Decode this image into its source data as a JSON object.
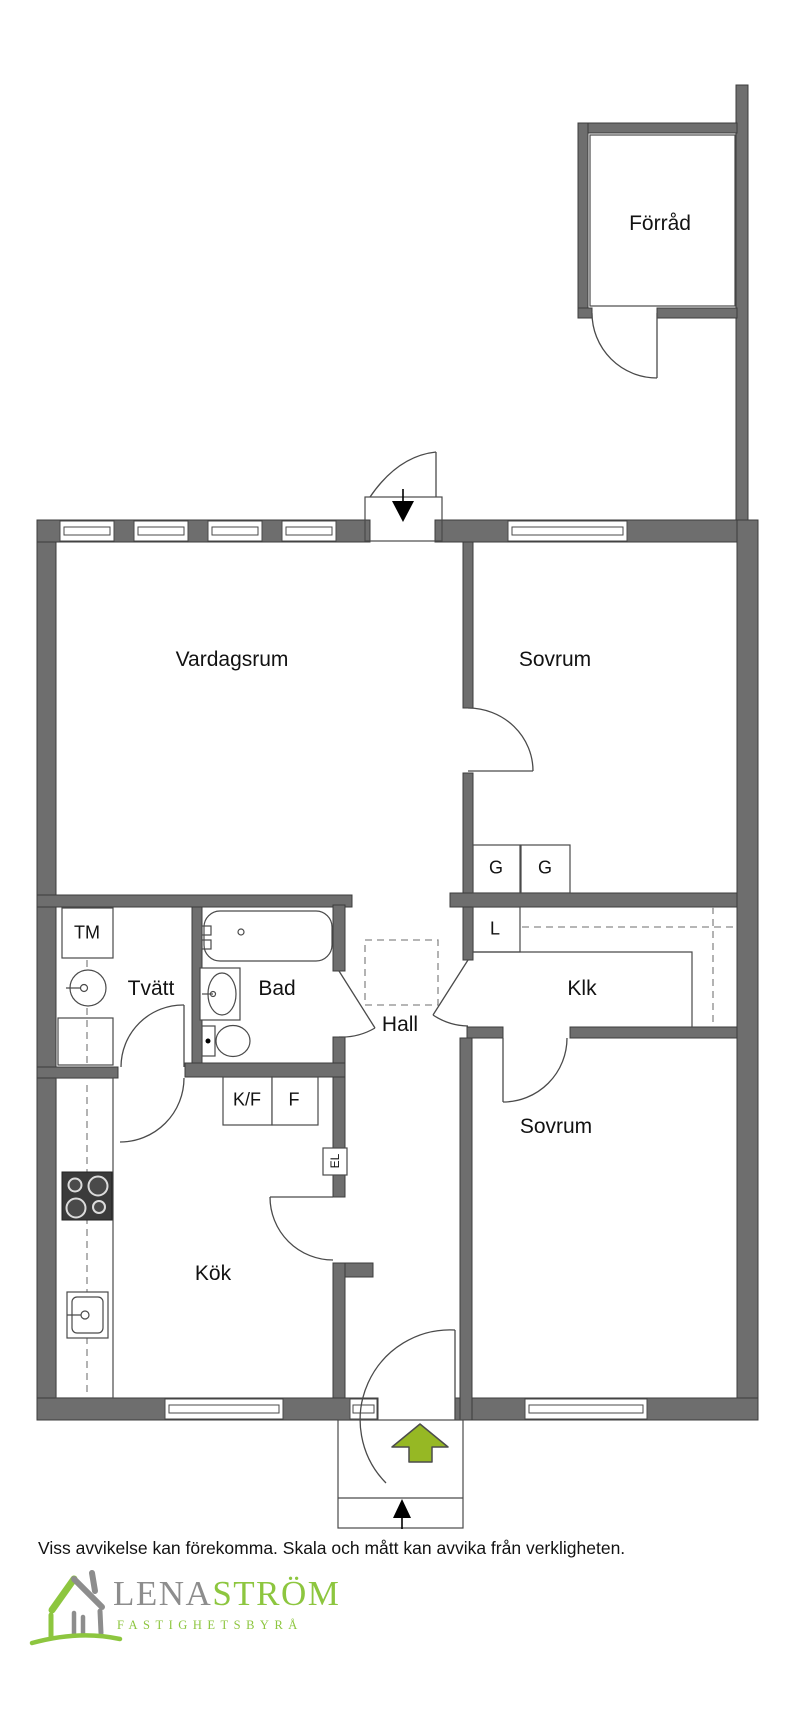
{
  "colors": {
    "wall": "#6e6e6e",
    "outline": "#3c3c3c",
    "line": "#4a4a4a",
    "dashed": "#8a8a8a",
    "arrow_green": "#96b824",
    "logo_green": "#8dc63f",
    "logo_gray": "#8d8d8d",
    "text": "#121212"
  },
  "floorplan": {
    "rooms": {
      "forrad": "Förråd",
      "vardagsrum": "Vardagsrum",
      "sovrum_top": "Sovrum",
      "sovrum_bottom": "Sovrum",
      "kok": "Kök",
      "hall": "Hall",
      "bad": "Bad",
      "tvatt": "Tvätt",
      "klk": "Klk"
    },
    "fixtures": {
      "tm": "TM",
      "g": "G",
      "l": "L",
      "kf": "K/F",
      "f": "F",
      "el": "EL"
    }
  },
  "disclaimer": "Viss avvikelse kan förekomma. Skala och mått kan avvika från verkligheten.",
  "logo": {
    "name_gray": "LENA",
    "name_green": "STRÖM",
    "subtitle": "FASTIGHETSBYRÅ"
  }
}
